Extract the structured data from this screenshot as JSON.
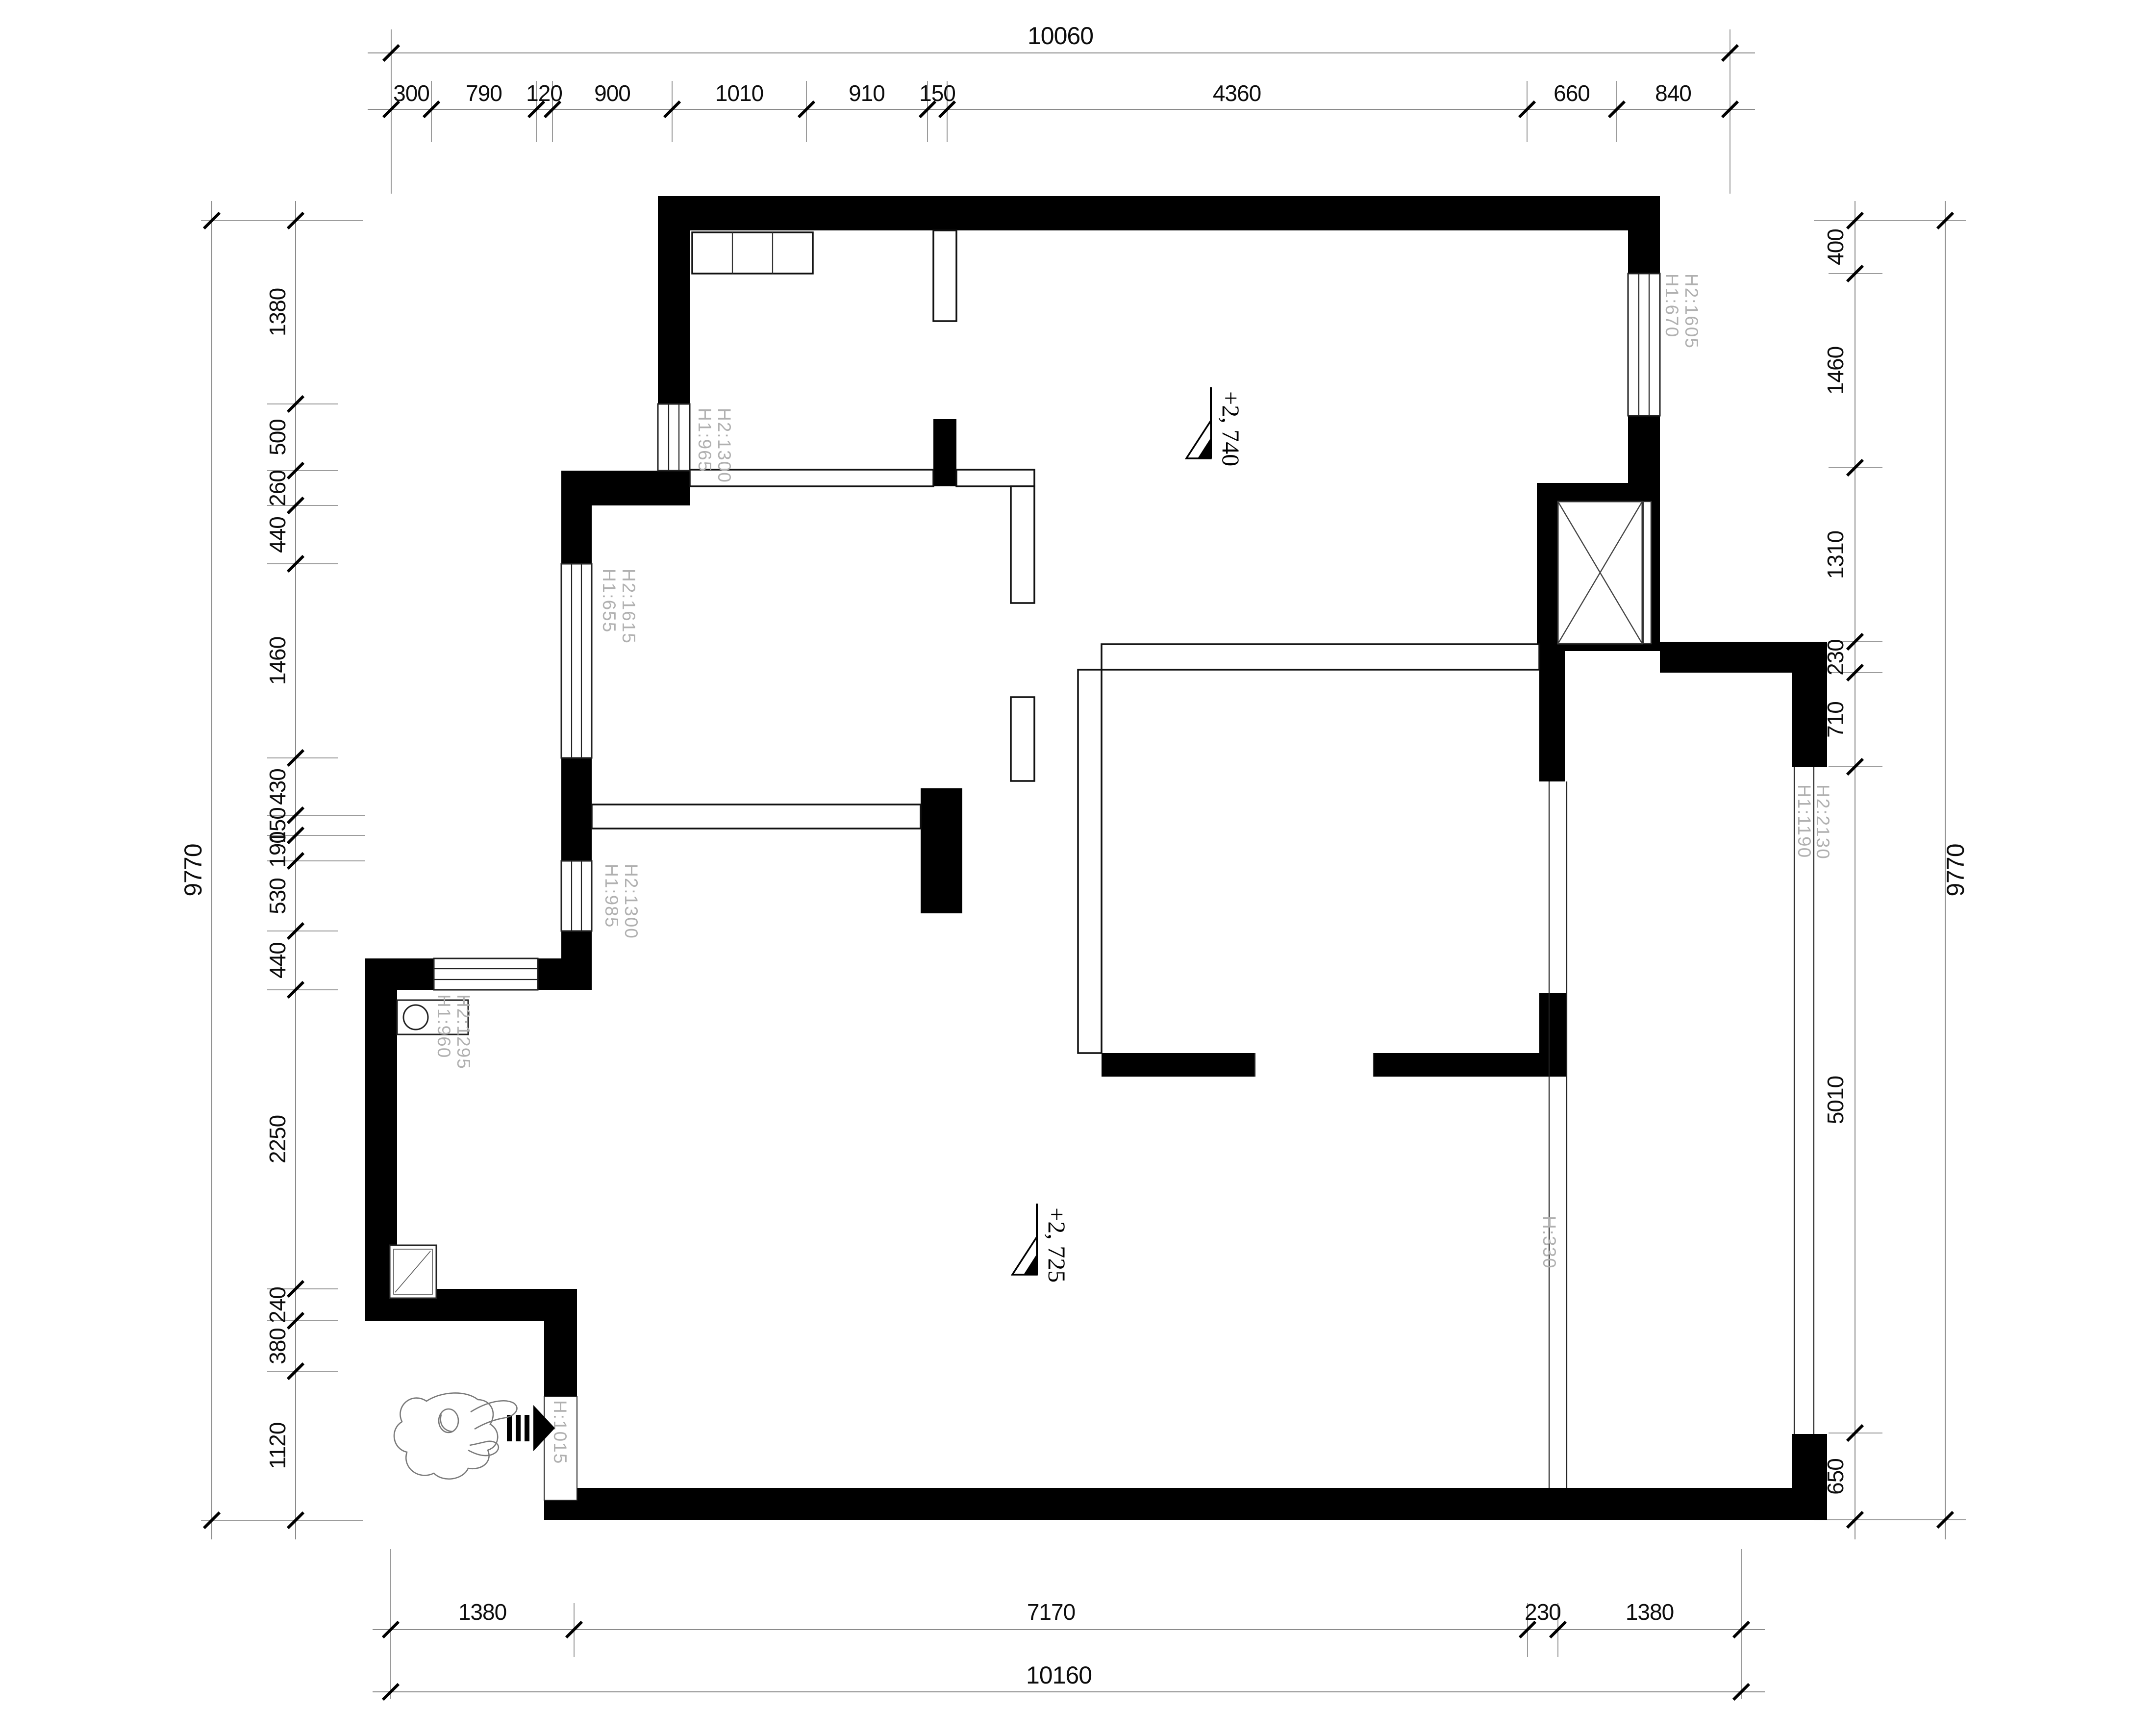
{
  "plan": {
    "totals": {
      "top": "10060",
      "bottom": "10160",
      "left": "9770",
      "right": "9770"
    },
    "chains": {
      "top": [
        "300",
        "790",
        "120",
        "900",
        "1010",
        "910",
        "150",
        "4360",
        "660",
        "840"
      ],
      "bottom": [
        "1380",
        "7170",
        "230",
        "1380"
      ],
      "left": [
        "1380",
        "500",
        "260",
        "440",
        "1460",
        "430",
        "150",
        "190",
        "530",
        "440",
        "2250",
        "240",
        "380",
        "1120"
      ],
      "right": [
        "400",
        "1460",
        "1310",
        "230",
        "710",
        "5010",
        "650"
      ]
    },
    "levels": {
      "upper": "+2, 740",
      "lower": "+2, 725"
    },
    "labels": {
      "win_top_left": [
        "H1:965",
        "H2:1300"
      ],
      "win_mid_left": [
        "H1:655",
        "H2:1615"
      ],
      "win_low_left": [
        "H1:985",
        "H2:1300"
      ],
      "win_kitchen": [
        "H1:960",
        "H2:1295"
      ],
      "win_right_top": [
        "H1:670",
        "H2:1605"
      ],
      "win_right_main": [
        "H1:1190",
        "H2:2130"
      ],
      "door_entry": "H:1015",
      "win_balcony_inner": "H:330"
    },
    "symbols": {
      "person": "person-top-view",
      "entry_arrow": "entry-direction-arrow",
      "elevator": "elevator-shaft-x"
    }
  }
}
